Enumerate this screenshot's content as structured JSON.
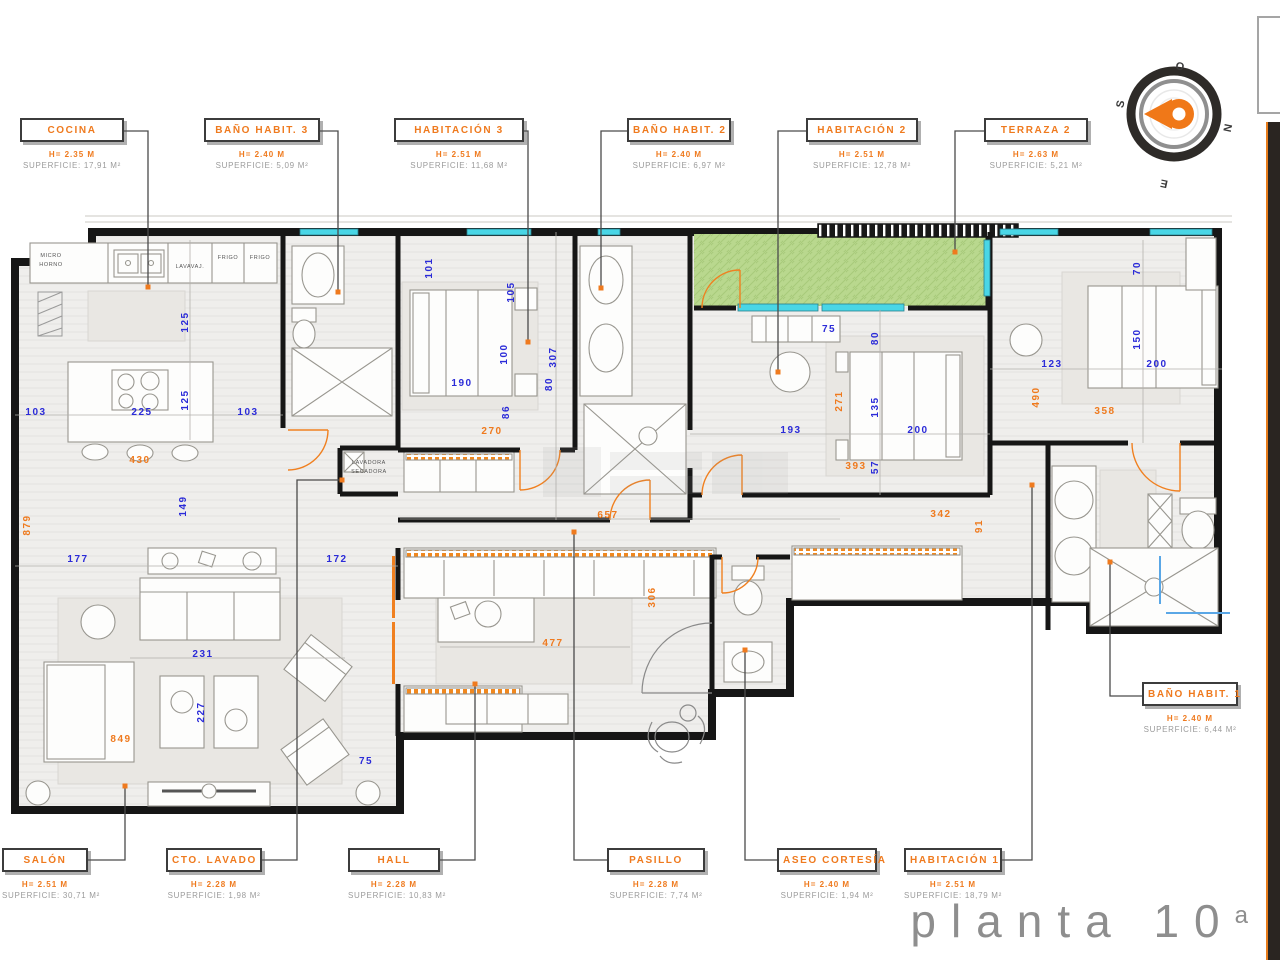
{
  "drawing_title": {
    "text": "planta 10",
    "sup": "a"
  },
  "compass": {
    "top": "O",
    "right": "N",
    "bottom": "E",
    "left": "S"
  },
  "accent_colors": {
    "orange": "#EF7A1E",
    "blue": "#2B2BD8",
    "terrace_green": "#B9D88E",
    "window_cyan": "#49D6E6"
  },
  "rooms": [
    {
      "id": "cocina",
      "name": "COCINA",
      "height": "H= 2.35 M",
      "area": "SUPERFICIE: 17,91 M²"
    },
    {
      "id": "bano-habit-3",
      "name": "BAÑO HABIT. 3",
      "height": "H= 2.40 M",
      "area": "SUPERFICIE: 5,09 M²"
    },
    {
      "id": "habitacion-3",
      "name": "HABITACIÓN 3",
      "height": "H= 2.51 M",
      "area": "SUPERFICIE: 11,68 M²"
    },
    {
      "id": "bano-habit-2",
      "name": "BAÑO HABIT. 2",
      "height": "H= 2.40 M",
      "area": "SUPERFICIE: 6,97 M²"
    },
    {
      "id": "habitacion-2",
      "name": "HABITACIÓN 2",
      "height": "H= 2.51 M",
      "area": "SUPERFICIE: 12,78 M²"
    },
    {
      "id": "terraza-2",
      "name": "TERRAZA 2",
      "height": "H= 2.63 M",
      "area": "SUPERFICIE: 5,21 M²"
    },
    {
      "id": "bano-habit-1",
      "name": "BAÑO HABIT. 1",
      "height": "H= 2.40 M",
      "area": "SUPERFICIE: 6,44 M²"
    },
    {
      "id": "salon",
      "name": "SALÓN",
      "height": "H= 2.51 M",
      "area": "SUPERFICIE: 30,71 M²"
    },
    {
      "id": "cto-lavado",
      "name": "CTO. LAVADO",
      "height": "H= 2.28 M",
      "area": "SUPERFICIE: 1,98 M²"
    },
    {
      "id": "hall",
      "name": "HALL",
      "height": "H= 2.28 M",
      "area": "SUPERFICIE: 10,83 M²"
    },
    {
      "id": "pasillo",
      "name": "PASILLO",
      "height": "H= 2.28 M",
      "area": "SUPERFICIE: 7,74 M²"
    },
    {
      "id": "aseo-cortesia",
      "name": "ASEO CORTESÍA",
      "height": "H= 2.40 M",
      "area": "SUPERFICIE: 1,94 M²"
    },
    {
      "id": "habitacion-1",
      "name": "HABITACIÓN 1",
      "height": "H= 2.51 M",
      "area": "SUPERFICIE: 18,79 M²"
    }
  ],
  "appliance_labels": [
    "MICRO",
    "HORNO",
    "LAVAVAJ.",
    "FRIGO",
    "FRIGO",
    "LAVADORA",
    "SECADORA"
  ],
  "dimensions_cm": {
    "blue": [
      {
        "v": "103",
        "x": 36,
        "y": 415
      },
      {
        "v": "225",
        "x": 142,
        "y": 415
      },
      {
        "v": "103",
        "x": 248,
        "y": 415
      },
      {
        "v": "125",
        "x": 188,
        "y": 322,
        "r": 1
      },
      {
        "v": "125",
        "x": 188,
        "y": 400,
        "r": 1
      },
      {
        "v": "190",
        "x": 462,
        "y": 386
      },
      {
        "v": "101",
        "x": 432,
        "y": 268,
        "r": 1
      },
      {
        "v": "105",
        "x": 514,
        "y": 292,
        "r": 1
      },
      {
        "v": "100",
        "x": 507,
        "y": 354,
        "r": 1
      },
      {
        "v": "307",
        "x": 556,
        "y": 357,
        "r": 1
      },
      {
        "v": "80",
        "x": 552,
        "y": 384,
        "r": 1
      },
      {
        "v": "86",
        "x": 509,
        "y": 412,
        "r": 1
      },
      {
        "v": "75",
        "x": 829,
        "y": 332
      },
      {
        "v": "80",
        "x": 878,
        "y": 338,
        "r": 1
      },
      {
        "v": "135",
        "x": 878,
        "y": 407,
        "r": 1
      },
      {
        "v": "200",
        "x": 918,
        "y": 433
      },
      {
        "v": "193",
        "x": 791,
        "y": 433
      },
      {
        "v": "57",
        "x": 878,
        "y": 467,
        "r": 1
      },
      {
        "v": "70",
        "x": 1140,
        "y": 268,
        "r": 1
      },
      {
        "v": "150",
        "x": 1140,
        "y": 339,
        "r": 1
      },
      {
        "v": "123",
        "x": 1052,
        "y": 367
      },
      {
        "v": "200",
        "x": 1157,
        "y": 367
      },
      {
        "v": "177",
        "x": 78,
        "y": 562
      },
      {
        "v": "172",
        "x": 337,
        "y": 562
      },
      {
        "v": "231",
        "x": 203,
        "y": 657
      },
      {
        "v": "227",
        "x": 204,
        "y": 712,
        "r": 1
      },
      {
        "v": "149",
        "x": 186,
        "y": 506,
        "r": 1
      },
      {
        "v": "75",
        "x": 366,
        "y": 764
      }
    ],
    "orange": [
      {
        "v": "430",
        "x": 140,
        "y": 463
      },
      {
        "v": "270",
        "x": 492,
        "y": 434
      },
      {
        "v": "879",
        "x": 30,
        "y": 525,
        "r": 1
      },
      {
        "v": "849",
        "x": 121,
        "y": 742
      },
      {
        "v": "657",
        "x": 608,
        "y": 518
      },
      {
        "v": "477",
        "x": 553,
        "y": 646
      },
      {
        "v": "306",
        "x": 655,
        "y": 597,
        "r": 1
      },
      {
        "v": "342",
        "x": 941,
        "y": 517
      },
      {
        "v": "91",
        "x": 982,
        "y": 526,
        "r": 1
      },
      {
        "v": "271",
        "x": 842,
        "y": 401,
        "r": 1
      },
      {
        "v": "393",
        "x": 856,
        "y": 469
      },
      {
        "v": "490",
        "x": 1039,
        "y": 397,
        "r": 1
      },
      {
        "v": "358",
        "x": 1105,
        "y": 414
      }
    ]
  }
}
